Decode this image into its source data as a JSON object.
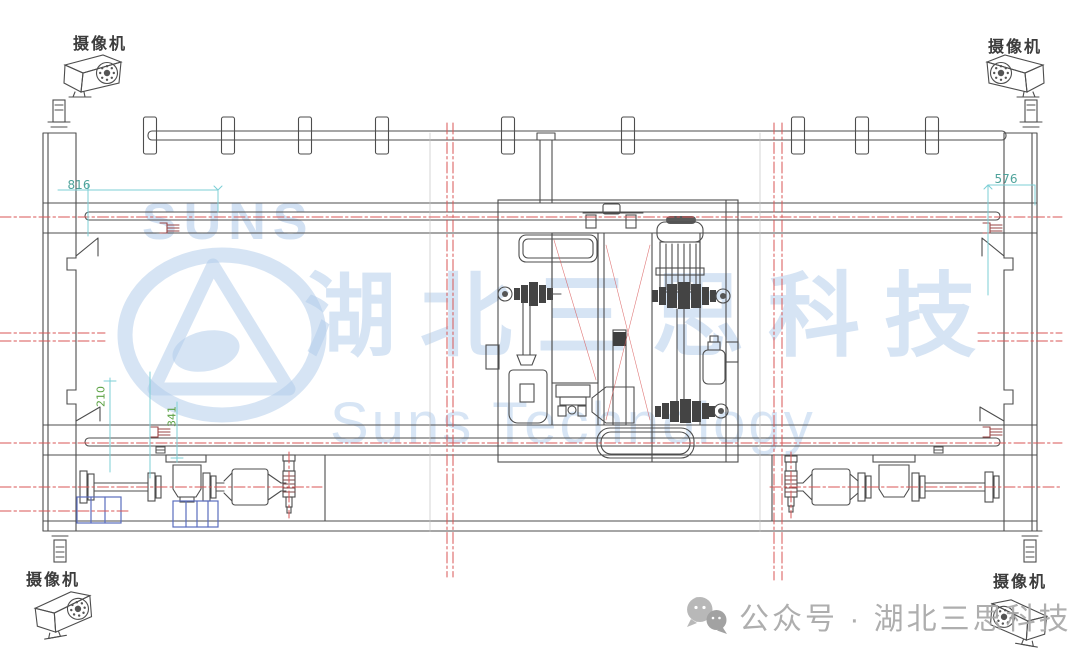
{
  "cameras": {
    "label": "摄像机",
    "instances": [
      {
        "position": "top-left"
      },
      {
        "position": "top-right"
      },
      {
        "position": "bottom-left"
      },
      {
        "position": "bottom-right"
      }
    ]
  },
  "dimensions": {
    "top_left": "816",
    "top_right": "576",
    "left_vertical_a": "210",
    "left_vertical_b": "341"
  },
  "watermark": {
    "brand_acronym": "SUNS",
    "brand_cn": "湖北三思科技",
    "brand_en": "Suns Technology",
    "color": "#cfe0f3"
  },
  "footer": {
    "icon": "wechat-icon",
    "text": "公众号 · 湖北三思科技",
    "color": "#a8a8a8"
  },
  "drawing": {
    "type": "engineering-elevation",
    "line_color": "#4d4d4d",
    "centerline_color": "#d85050",
    "dimension_color": "#6cc5cf",
    "annotation_green": "#5ca244",
    "detail_blue": "#5b6dbf"
  }
}
